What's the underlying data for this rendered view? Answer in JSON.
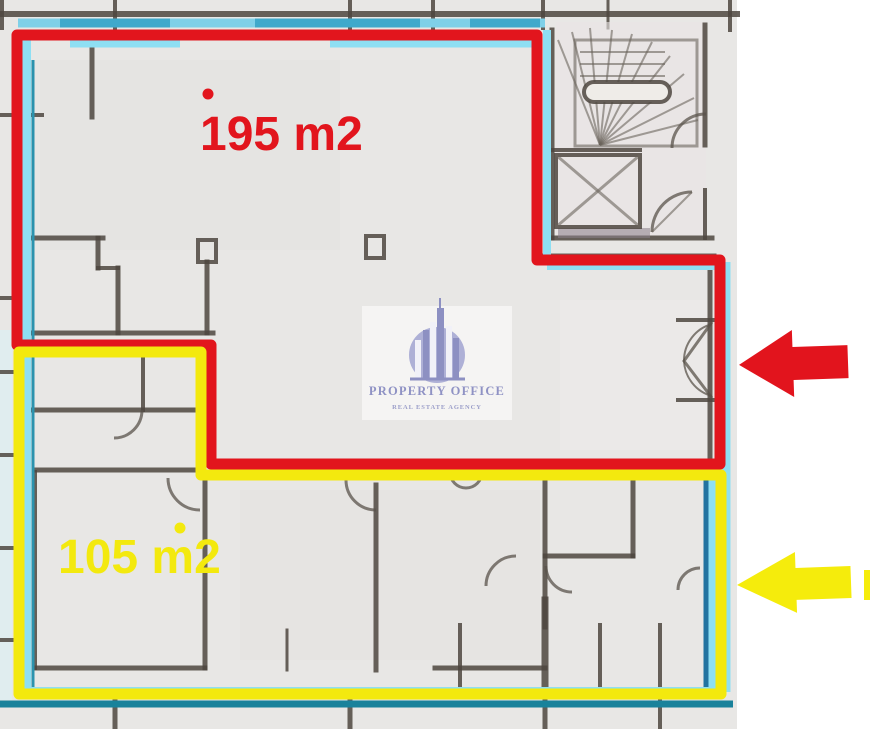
{
  "image": {
    "kind": "scanned real-estate floor plan with unit overlays"
  },
  "overlays": {
    "unit_a": {
      "label": "195 m2",
      "color": "#e2151d"
    },
    "unit_b": {
      "label": "105 m2",
      "color": "#f3e90e"
    }
  },
  "arrows": {
    "red": {
      "icon": "left-arrow-icon",
      "color": "#e2141d"
    },
    "yellow": {
      "icon": "left-arrow-icon",
      "color": "#f5ec0c"
    }
  },
  "watermark": {
    "title": "PROPERTY OFFICE",
    "subtitle": "REAL ESTATE AGENCY",
    "logo": "buildings-in-circle-icon",
    "color": "#8f92c4"
  },
  "plan": {
    "outline_color": "#8edff3",
    "window_band_color": "#3fa9cb",
    "features": [
      "staircase",
      "elevator-shaft",
      "door-swings"
    ]
  }
}
